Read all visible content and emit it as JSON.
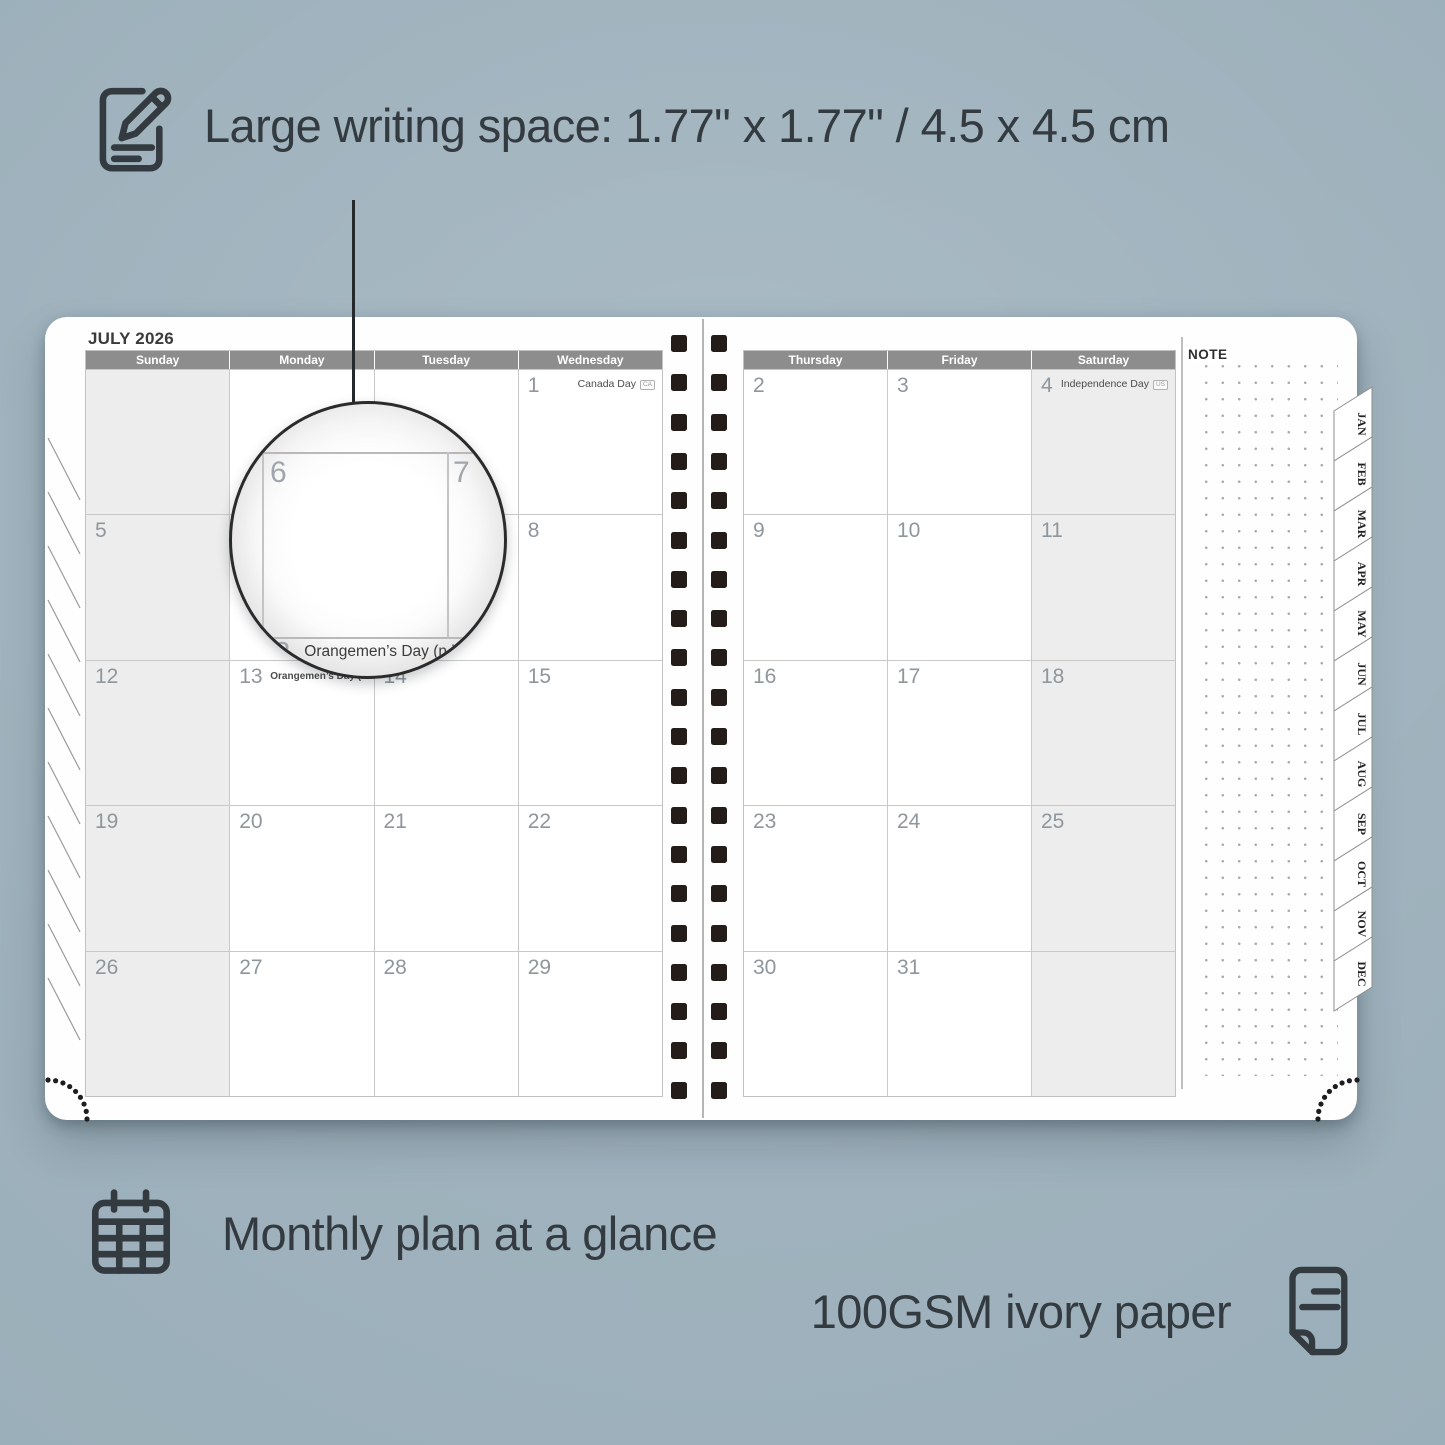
{
  "colors": {
    "background": "#9db0bb",
    "ink": "#333b40",
    "header_band": "#8d8d8d",
    "weekend_shade": "#ededed",
    "grid_line": "#c9c9c9",
    "binding": "#231c19"
  },
  "annotations": {
    "writing_space": "Large writing space: 1.77\" x 1.77\" / 4.5 x 4.5 cm",
    "monthly_plan": "Monthly plan at a glance",
    "paper": "100GSM ivory paper"
  },
  "planner": {
    "month_title": "JULY 2026",
    "note_label": "NOTE",
    "month_tabs": [
      "JAN",
      "FEB",
      "MAR",
      "APR",
      "MAY",
      "JUN",
      "JUL",
      "AUG",
      "SEP",
      "OCT",
      "NOV",
      "DEC"
    ],
    "left_page": {
      "headers": [
        "Sunday",
        "Monday",
        "Tuesday",
        "Wednesday"
      ],
      "shaded_columns": [
        0
      ],
      "rows": [
        [
          {
            "day": ""
          },
          {
            "day": ""
          },
          {
            "day": ""
          },
          {
            "day": "1",
            "holiday": "Canada Day",
            "badge": "CA"
          }
        ],
        [
          {
            "day": "5"
          },
          {
            "day": "6"
          },
          {
            "day": "7"
          },
          {
            "day": "8"
          }
        ],
        [
          {
            "day": "12"
          },
          {
            "day": "13",
            "holiday": "Orangemen’s Day (n.i.)",
            "badge": "UK",
            "left": true
          },
          {
            "day": "14"
          },
          {
            "day": "15"
          }
        ],
        [
          {
            "day": "19"
          },
          {
            "day": "20"
          },
          {
            "day": "21"
          },
          {
            "day": "22"
          }
        ],
        [
          {
            "day": "26"
          },
          {
            "day": "27"
          },
          {
            "day": "28"
          },
          {
            "day": "29"
          }
        ]
      ]
    },
    "right_page": {
      "headers": [
        "Thursday",
        "Friday",
        "Saturday"
      ],
      "shaded_columns": [
        2
      ],
      "rows": [
        [
          {
            "day": "2"
          },
          {
            "day": "3"
          },
          {
            "day": "4",
            "holiday": "Independence Day",
            "badge": "US"
          }
        ],
        [
          {
            "day": "9"
          },
          {
            "day": "10"
          },
          {
            "day": "11"
          }
        ],
        [
          {
            "day": "16"
          },
          {
            "day": "17"
          },
          {
            "day": "18"
          }
        ],
        [
          {
            "day": "23"
          },
          {
            "day": "24"
          },
          {
            "day": "25"
          }
        ],
        [
          {
            "day": "30"
          },
          {
            "day": "31"
          },
          {
            "day": ""
          }
        ]
      ]
    },
    "magnifier": {
      "left_day": "6",
      "right_day": "7",
      "bottom_day": "13",
      "bottom_holiday": "Orangemen’s Day (n.i.)",
      "bottom_badge": "UK"
    }
  }
}
